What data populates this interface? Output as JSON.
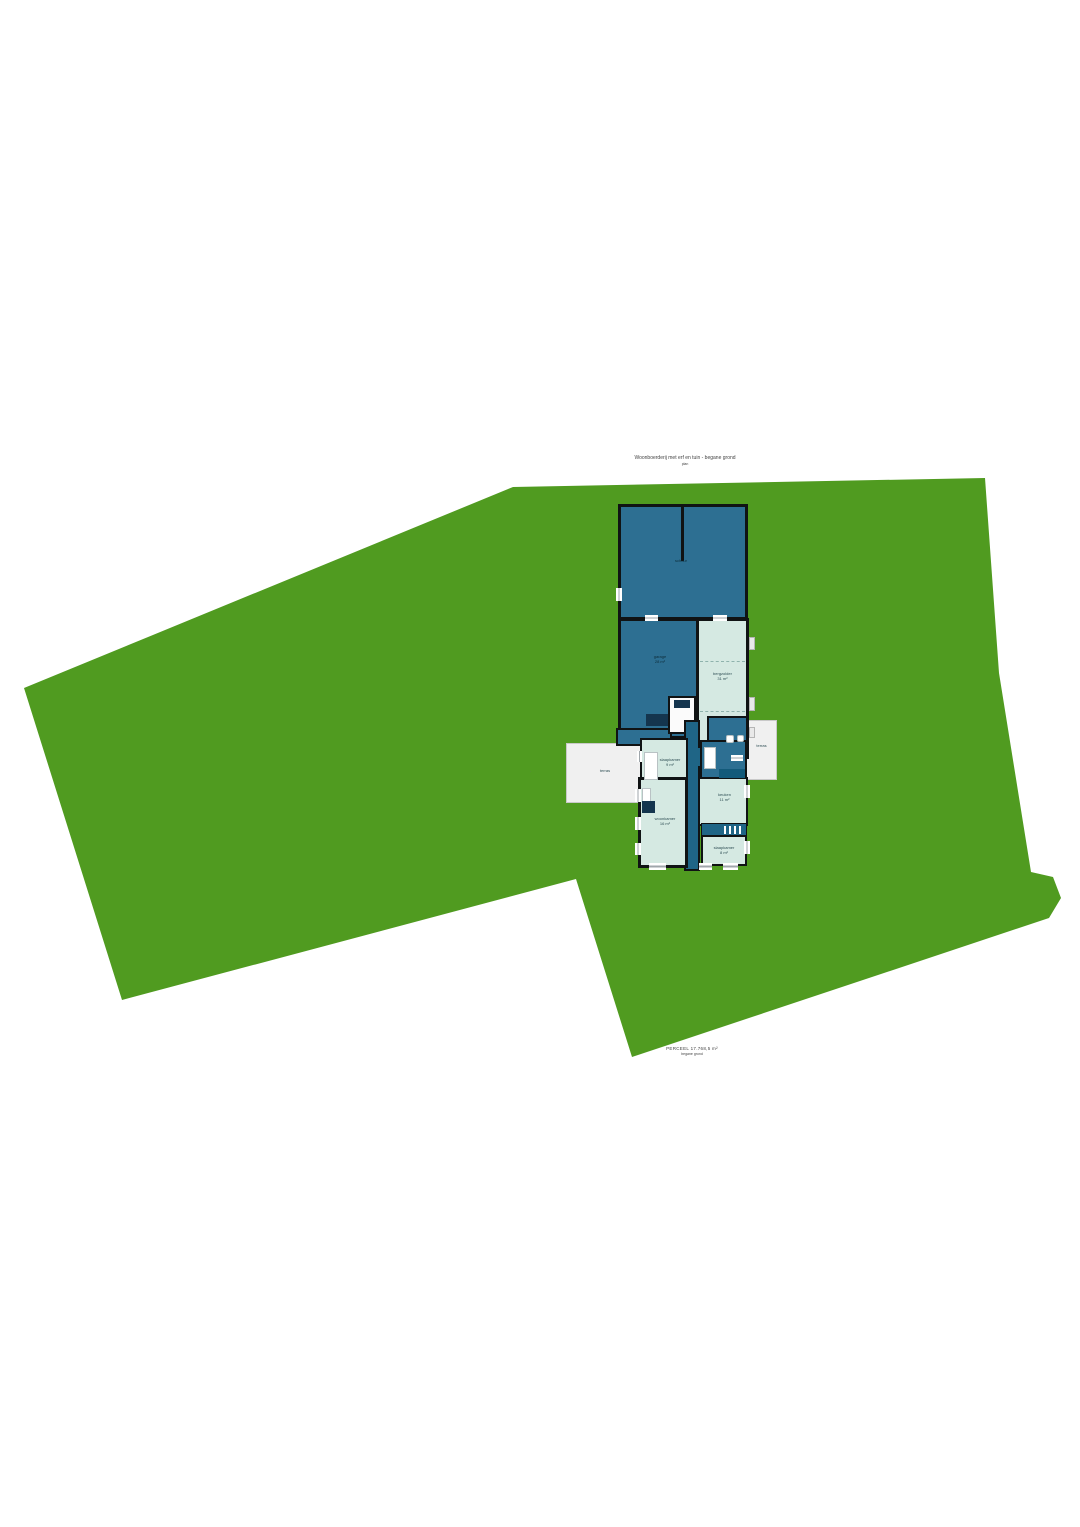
{
  "colors": {
    "land": "#509b20",
    "room_dark": "#2d6f92",
    "room_mint": "#d5e9e2",
    "corridor": "#1f6586",
    "furn_navy": "#14354e",
    "wall": "#101314",
    "terrace": "#f0f0f0",
    "terrace_border": "#c9c9c9",
    "winline": "#9fa6ab",
    "label_dark": "#0e2d3a",
    "label_mint": "#2f4f55",
    "title": "#444444"
  },
  "site": {
    "polygon_points": "513,487 985,478 999,673 1031,872 1053,877 1061,898 1049,918 632,1057 576,879 122,1000 24,688"
  },
  "header": {
    "line1": "Woonboerderij met erf en tuin - begane grond",
    "line2": "plan"
  },
  "footer": {
    "line1": "PERCEEL 17.768,5 m²",
    "line2": "begane grond"
  },
  "rooms": {
    "barn": {
      "label": "schuur"
    },
    "garage": {
      "label": "garage\n28 m²"
    },
    "attic": {
      "label": "bergzolder\n31 m²"
    },
    "bed1": {
      "label": "slaapkamer\n9 m²"
    },
    "living": {
      "label": "woonkamer\n16 m²"
    },
    "kitchen": {
      "label": "keuken\n11 m²"
    },
    "bed3": {
      "label": "slaapkamer\n8 m²"
    },
    "terrace_left": {
      "label": "terras"
    },
    "terrace_right": {
      "label": "terras"
    }
  },
  "marks": {
    "left_dot": "·",
    "bottom_dot": "·"
  }
}
